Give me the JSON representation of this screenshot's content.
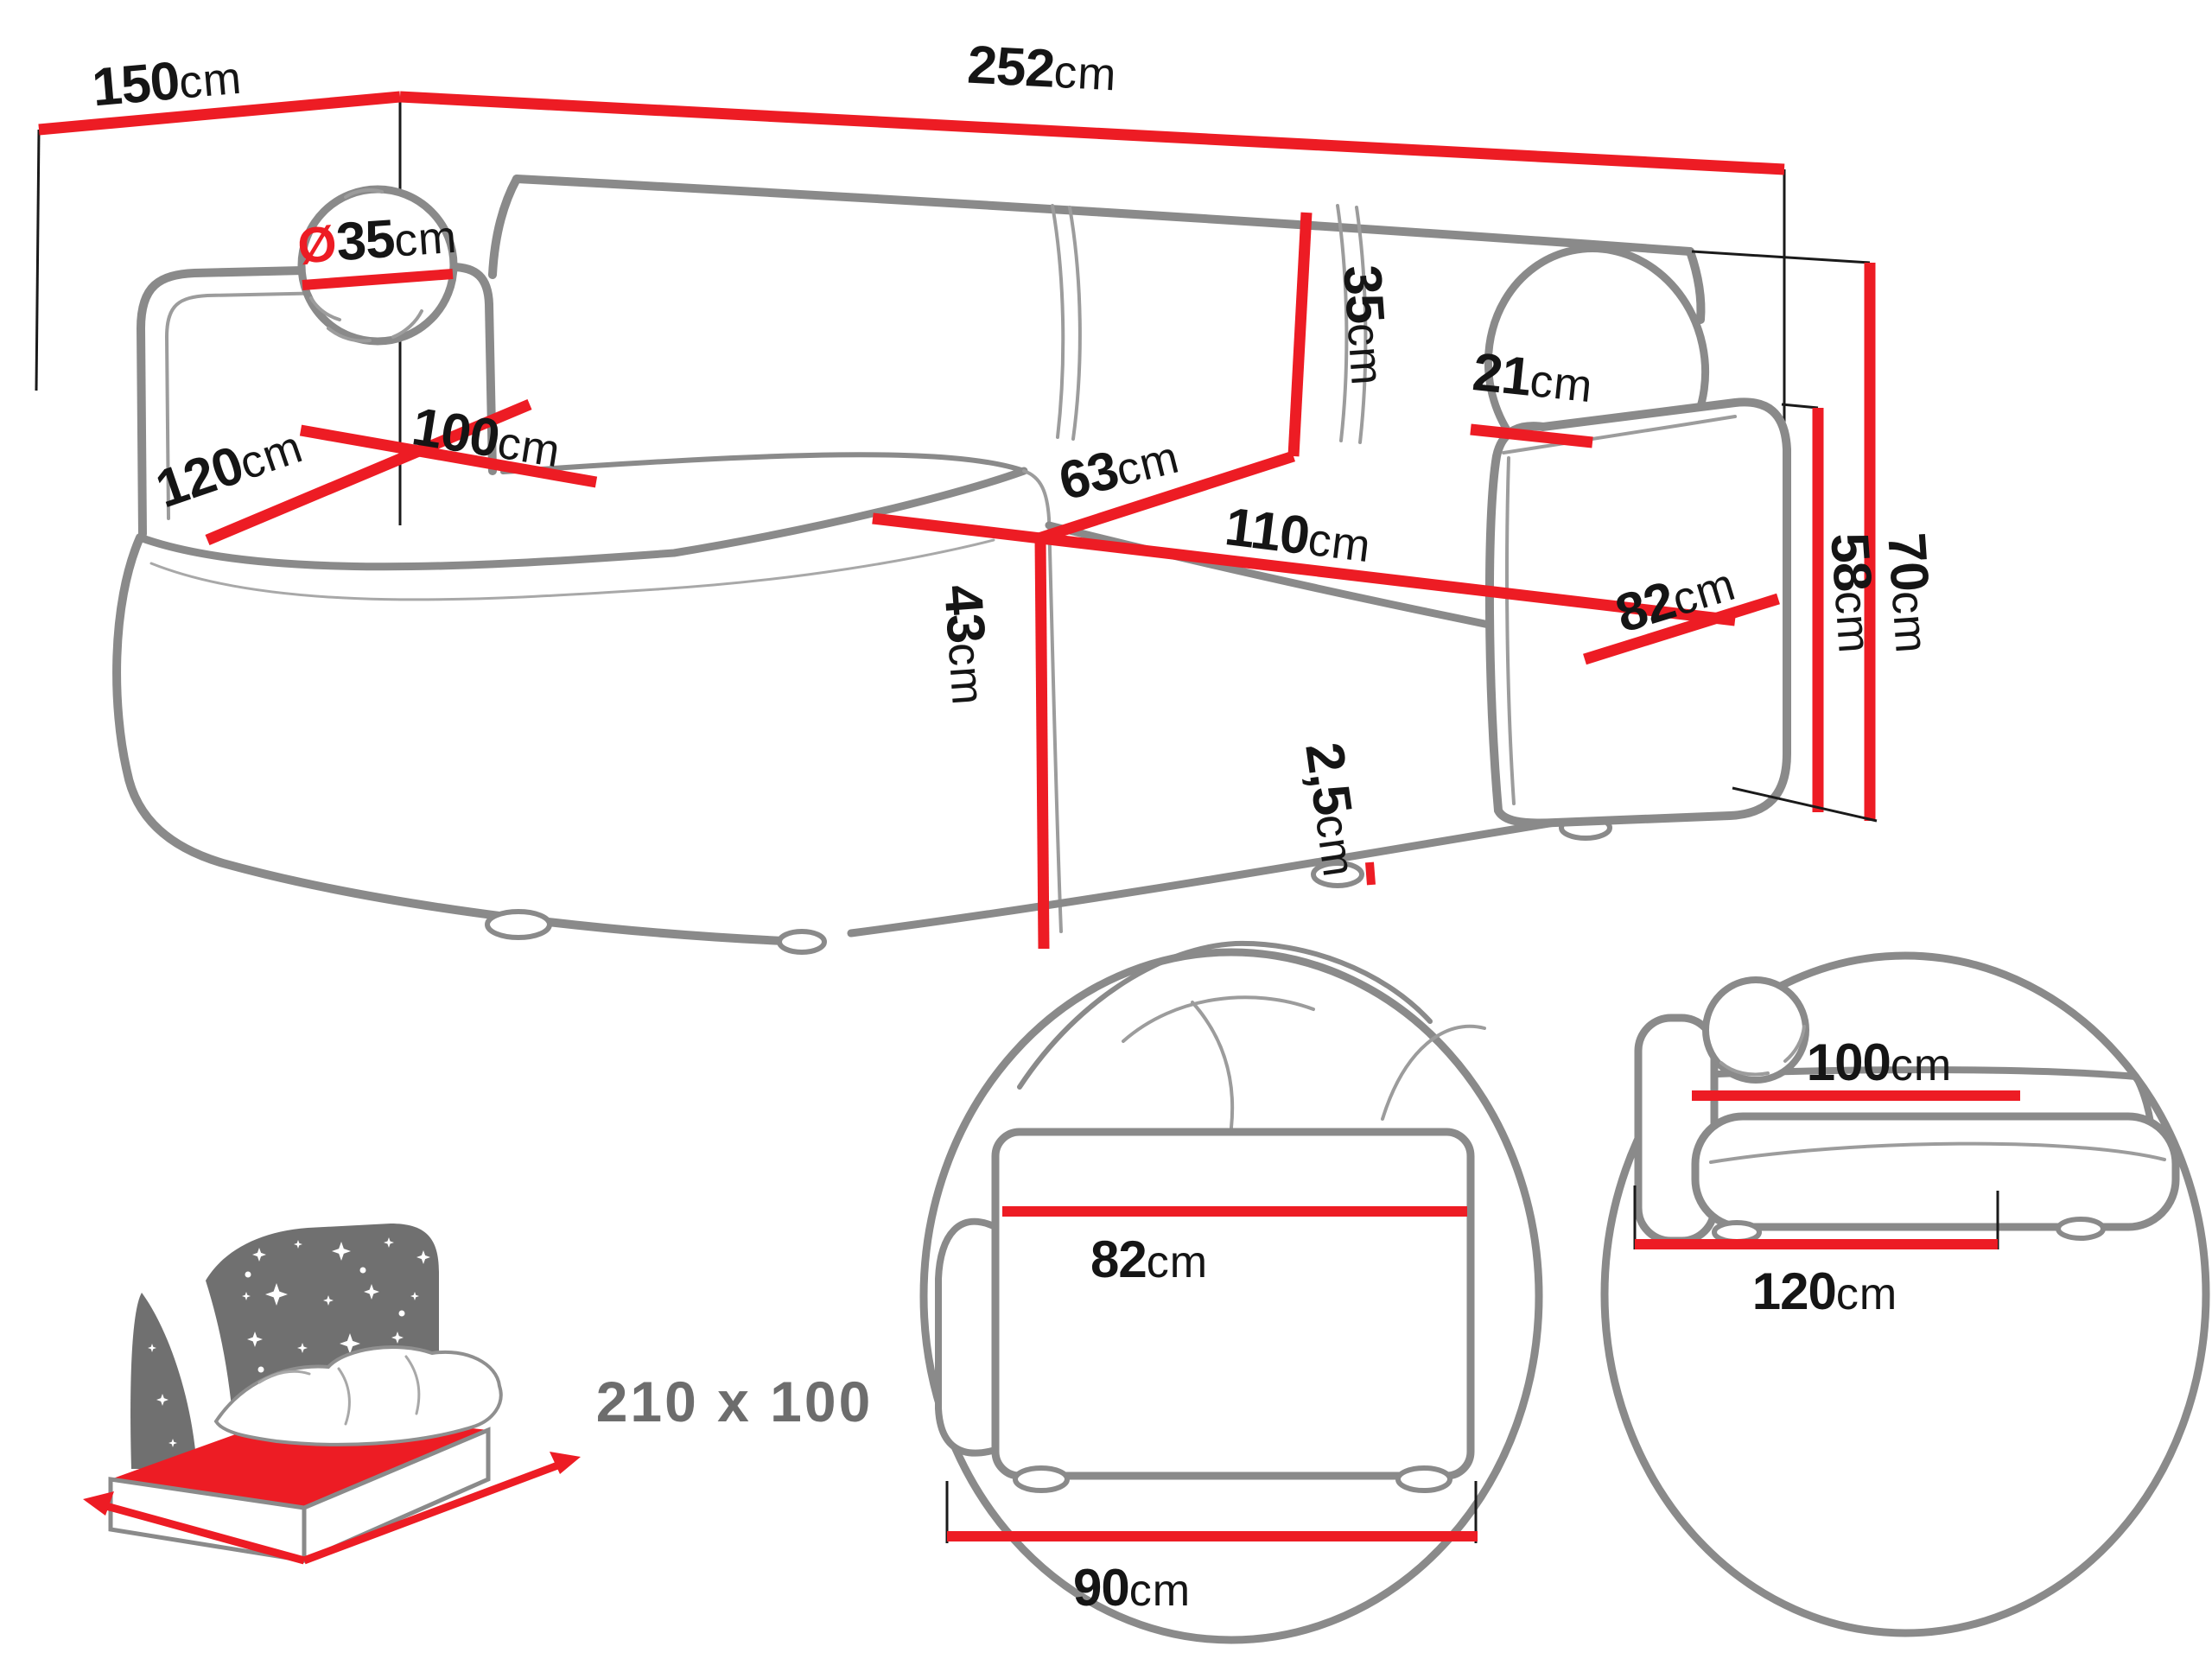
{
  "page": {
    "title": "Corner sofa dimensions diagram"
  },
  "colors": {
    "accent_red": "#ED1C24",
    "outline_gray": "#8A8A8A",
    "text_black": "#151515",
    "icon_gray": "#707070",
    "muted_gray": "#6D6D6D"
  },
  "icons": {
    "sleeping_area": "bed-with-starry-headboard-icon",
    "detail_side": "magnified-circle-side-view",
    "detail_front": "magnified-circle-front-view"
  },
  "dims": {
    "d150": {
      "value": "150",
      "unit": "cm"
    },
    "d252": {
      "value": "252",
      "unit": "cm"
    },
    "dpillow": {
      "prefix": "Ø",
      "value": "35",
      "unit": "cm"
    },
    "d35": {
      "value": "35",
      "unit": "cm"
    },
    "d120": {
      "value": "120",
      "unit": "cm"
    },
    "d100": {
      "value": "100",
      "unit": "cm"
    },
    "d63": {
      "value": "63",
      "unit": "cm"
    },
    "d110": {
      "value": "110",
      "unit": "cm"
    },
    "d43": {
      "value": "43",
      "unit": "cm"
    },
    "d21": {
      "value": "21",
      "unit": "cm"
    },
    "d82": {
      "value": "82",
      "unit": "cm"
    },
    "d58": {
      "value": "58",
      "unit": "cm"
    },
    "d70": {
      "value": "70",
      "unit": "cm"
    },
    "d25": {
      "value": "2,5",
      "unit": "cm"
    }
  },
  "insets": {
    "sleeping_area": {
      "label": "210 x 100"
    },
    "side_view": {
      "top": {
        "value": "82",
        "unit": "cm"
      },
      "bottom": {
        "value": "90",
        "unit": "cm"
      }
    },
    "front_view": {
      "top": {
        "value": "100",
        "unit": "cm"
      },
      "bottom": {
        "value": "120",
        "unit": "cm"
      }
    }
  }
}
